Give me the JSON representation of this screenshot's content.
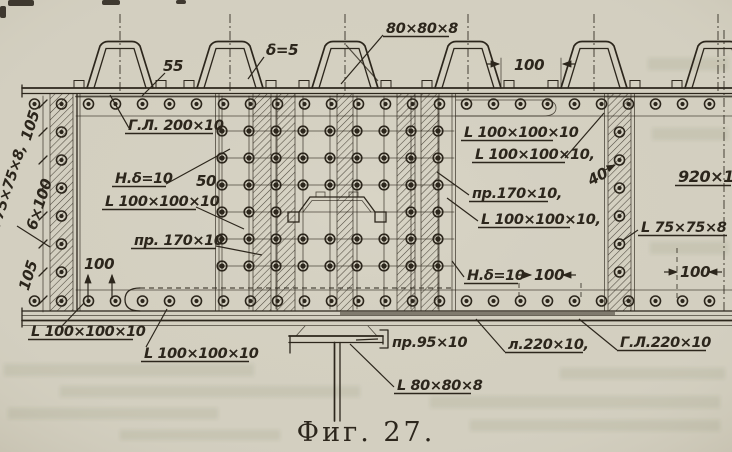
{
  "figure": {
    "caption": "Фиг. 27."
  },
  "colors": {
    "paper": "#d3cfc0",
    "ink": "#2c261c",
    "ghost": "#55663f"
  },
  "labels": {
    "top_plate": "80×80×8",
    "delta": "δ=5",
    "gl200": "Г.Л. 200×10",
    "nd10": "Н.δ=10",
    "l100": "L 100×100×10",
    "l100c": "L 100×100×10,",
    "pr170": "пр. 170×10",
    "pr170c": "пр.170×10,",
    "l75c": "L 75×75×8,",
    "l75": "L 75×75×8",
    "p920": "920×10",
    "pr95": "пр.95×10",
    "l220": "л.220×10,",
    "gl220": "Г.Л.220×10",
    "l80": "L 80×80×8"
  },
  "dims": {
    "d55": "55",
    "d50": "50",
    "d40": "40",
    "d100": "100",
    "d105": "105",
    "d6x100": "6×100",
    "d920": "920×10"
  }
}
